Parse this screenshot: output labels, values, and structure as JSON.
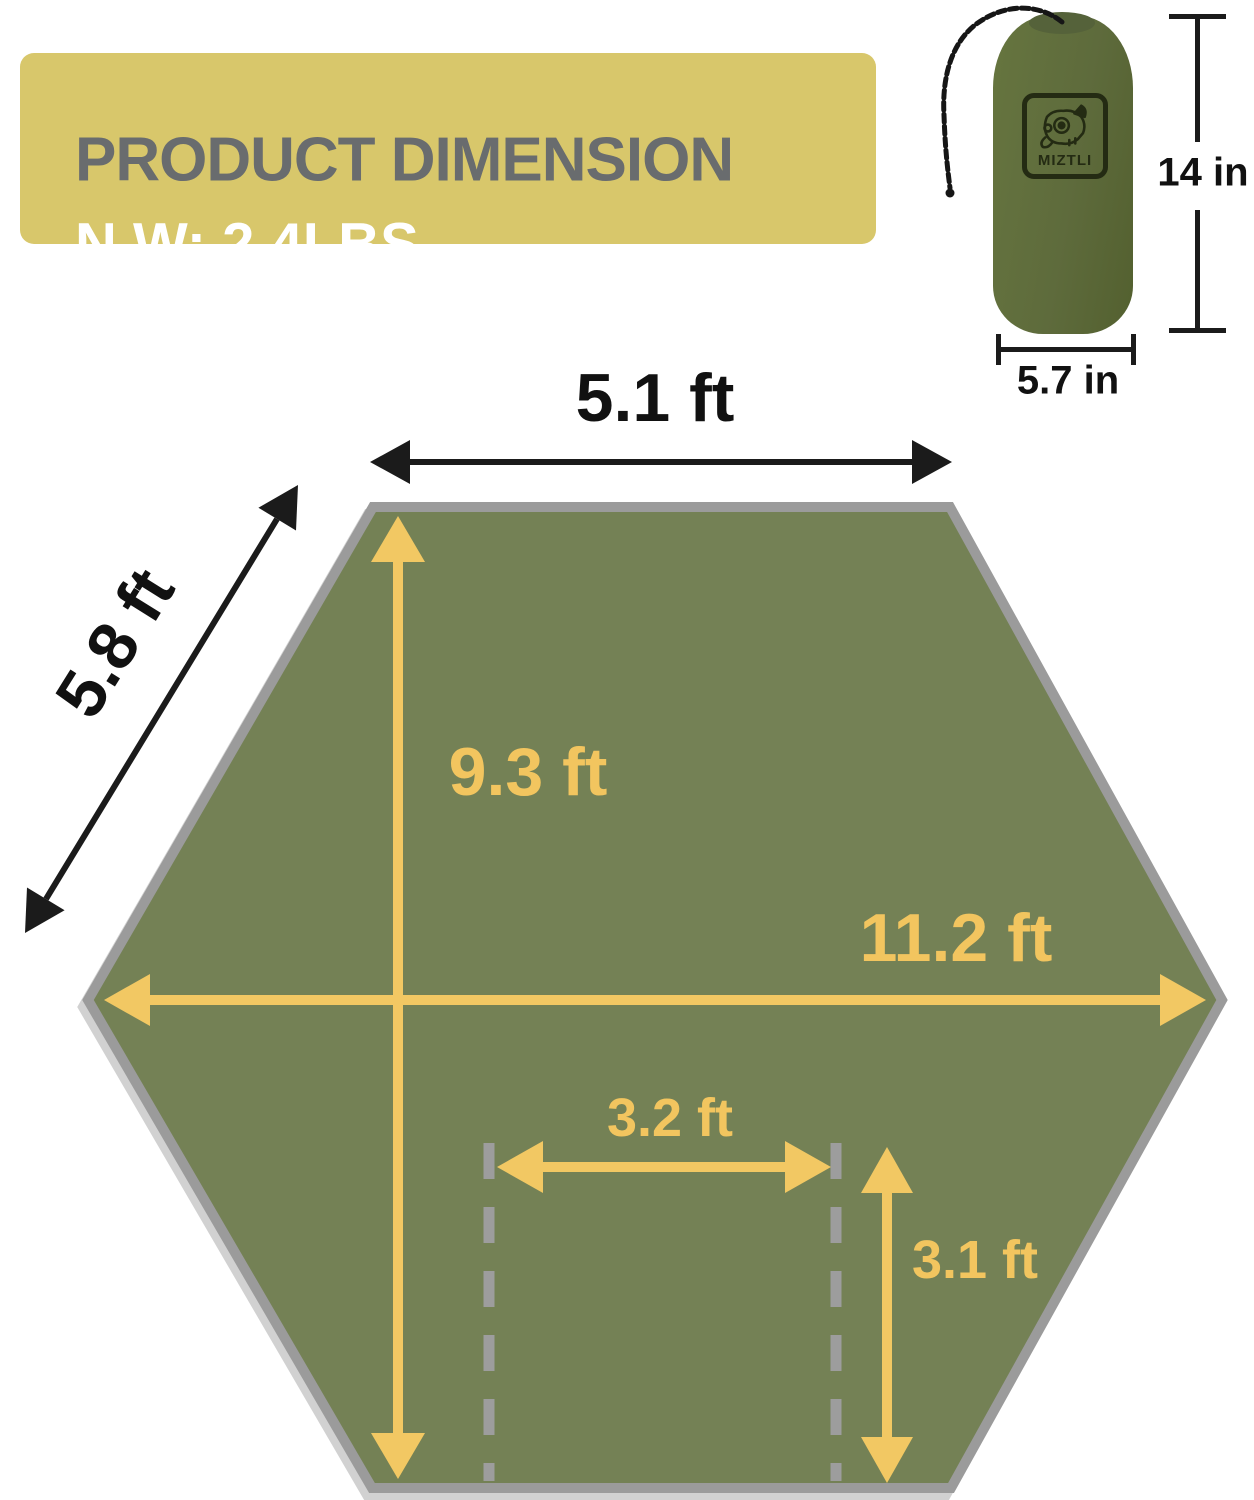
{
  "banner": {
    "title": "PRODUCT DIMENSION",
    "weight": "N.W: 2.4LBS"
  },
  "stuff_sack": {
    "brand": "MIZTLI",
    "height": "14 in",
    "width": "5.7 in"
  },
  "tarp": {
    "top_edge": "5.1 ft",
    "diagonal_edge": "5.8 ft",
    "height": "9.3 ft",
    "width": "11.2 ft",
    "inner_width": "3.2 ft",
    "inner_height": "3.1 ft"
  },
  "colors": {
    "banner_bg": "#D8C76B",
    "title_gray": "#696C6E",
    "hexagon_fill": "#748155",
    "hexagon_border": "#9B9B9B",
    "arrow_yellow": "#F2C863",
    "label_yellow": "#F2C55F",
    "ink_black": "#1B1B1B",
    "dashed_gray": "#9D9D9D",
    "bag_green": "#5E6B3C"
  }
}
